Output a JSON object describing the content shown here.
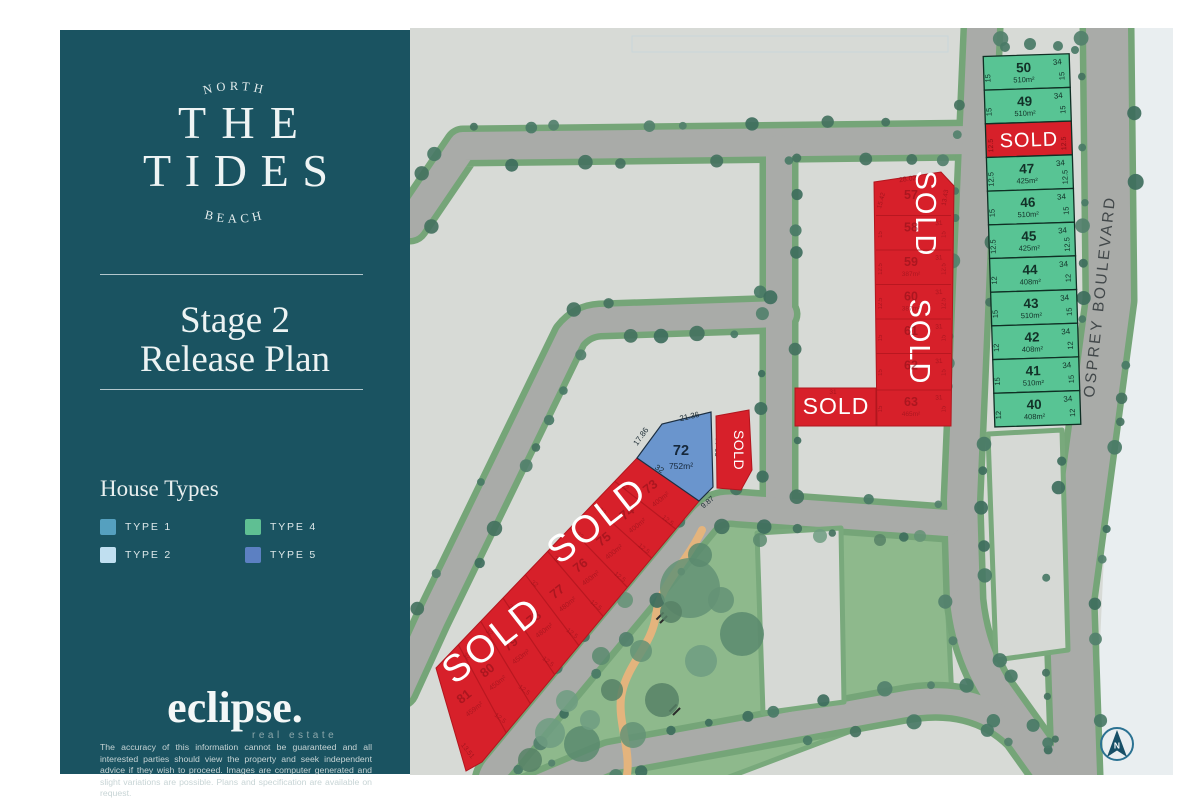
{
  "sidebar": {
    "logo": {
      "arc_top": "NORTH",
      "line1": "THE",
      "line2": "TIDES",
      "arc_bottom": "BEACH"
    },
    "stage_line1": "Stage 2",
    "stage_line2": "Release Plan",
    "house_types_heading": "House Types",
    "legend": [
      {
        "label": "TYPE 1",
        "color": "#55a0bf"
      },
      {
        "label": "TYPE 2",
        "color": "#c0dff0"
      },
      {
        "label": "TYPE 4",
        "color": "#5fbf93"
      },
      {
        "label": "TYPE 5",
        "color": "#5c80c2"
      }
    ],
    "brand_name": "eclipse.",
    "brand_tagline": "real estate",
    "disclaimer": "The accuracy of this information cannot be guaranteed and all interested parties should view the property and seek independent advice if they wish to proceed. Images are computer generated and slight variations are possible. Plans and specification are available on request."
  },
  "map": {
    "street_name": "OSPREY BOULEVARD",
    "north_label": "N",
    "sold_label": "SOLD",
    "colors": {
      "lot_green": "#58c494",
      "lot_blue": "#6a95cd",
      "sold_red": "#d7202a",
      "road": "#a9aba8",
      "verge": "#75a578",
      "park": "#8eb98c",
      "map_bg": "#d7dad6",
      "faint_red_text": "#8f1019",
      "sidebar": "#1a5361"
    },
    "boulevard_lots": [
      {
        "num": "50",
        "area": "510m²",
        "front": "34",
        "left": "15",
        "right": "15",
        "sold": false
      },
      {
        "num": "49",
        "area": "510m²",
        "front": "34",
        "left": "15",
        "right": "15",
        "sold": false
      },
      {
        "num": "48",
        "area": "",
        "front": "",
        "left": "12.5",
        "right": "12.5",
        "sold": true
      },
      {
        "num": "47",
        "area": "425m²",
        "front": "34",
        "left": "12.5",
        "right": "12.5",
        "sold": false
      },
      {
        "num": "46",
        "area": "510m²",
        "front": "34",
        "left": "15",
        "right": "15",
        "sold": false
      },
      {
        "num": "45",
        "area": "425m²",
        "front": "34",
        "left": "12.5",
        "right": "12.5",
        "sold": false
      },
      {
        "num": "44",
        "area": "408m²",
        "front": "34",
        "left": "12",
        "right": "12",
        "sold": false
      },
      {
        "num": "43",
        "area": "510m²",
        "front": "34",
        "left": "15",
        "right": "15",
        "sold": false
      },
      {
        "num": "42",
        "area": "408m²",
        "front": "34",
        "left": "12",
        "right": "12",
        "sold": false
      },
      {
        "num": "41",
        "area": "510m²",
        "front": "34",
        "left": "15",
        "right": "15",
        "sold": false
      },
      {
        "num": "40",
        "area": "408m²",
        "front": "34",
        "left": "12",
        "right": "12",
        "sold": false
      }
    ],
    "inner_block": {
      "top_dim": "28.02",
      "top_left_dim": "15.42",
      "top_right_dim": "13.43",
      "annex_front": "31",
      "cells": [
        {
          "num": "57",
          "area": "",
          "front": "",
          "left": "",
          "right": ""
        },
        {
          "num": "58",
          "area": "",
          "front": "31",
          "left": "15",
          "right": "15"
        },
        {
          "num": "59",
          "area": "387m²",
          "front": "31",
          "left": "12.5",
          "right": "12.5"
        },
        {
          "num": "60",
          "area": "387m²",
          "front": "31",
          "left": "12.5",
          "right": "12.5"
        },
        {
          "num": "61",
          "area": "",
          "front": "31",
          "left": "15",
          "right": "15"
        },
        {
          "num": "62",
          "area": "",
          "front": "31",
          "left": "15",
          "right": "15"
        },
        {
          "num": "63",
          "area": "465m²",
          "front": "31",
          "left": "15",
          "right": "15"
        }
      ]
    },
    "lot72": {
      "num": "72",
      "area": "752m²",
      "dim_nw": "17.86",
      "dim_top": "21.36",
      "dim_right": "28.18",
      "dim_left": "32",
      "dim_bottom": "9.87"
    },
    "strip": {
      "side_dim": "32",
      "width_dim": "12.5",
      "end_dim": "13.51",
      "lots": [
        {
          "num": "73",
          "area": "400m²"
        },
        {
          "num": "74",
          "area": "400m²"
        },
        {
          "num": "75",
          "area": "400m²"
        },
        {
          "num": "76",
          "area": "460m²"
        },
        {
          "num": "77",
          "area": "480m²"
        },
        {
          "num": "78",
          "area": "480m²"
        },
        {
          "num": "79",
          "area": "450m²"
        },
        {
          "num": "80",
          "area": "450m²"
        },
        {
          "num": "81",
          "area": "459m²"
        }
      ]
    }
  }
}
